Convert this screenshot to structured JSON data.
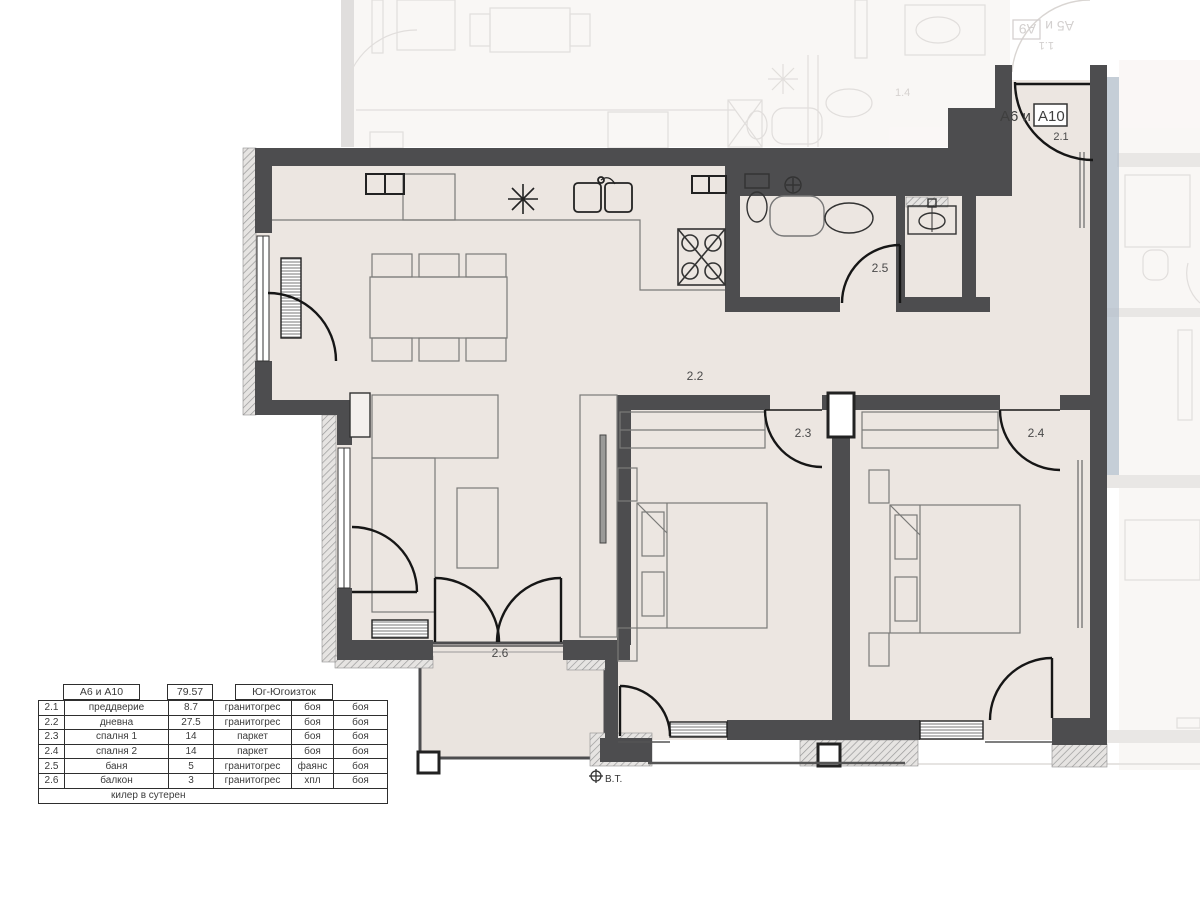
{
  "plan": {
    "apartment_label": {
      "prefix": "А6 и",
      "boxed": "А10"
    },
    "room_labels": {
      "r21": "2.1",
      "r22": "2.2",
      "r23": "2.3",
      "r24": "2.4",
      "r25": "2.5",
      "r26": "2.6"
    },
    "survey_marker": "В.Т.",
    "faded_labels": {
      "upper_apartment_prefix": "А5 и",
      "upper_apartment_boxed": "А9",
      "upper_room": "1.1",
      "upper_neighbor_room": "1.4"
    },
    "colors": {
      "wall": "#4d4d4f",
      "floor": "#ece6e1",
      "accent_band": "#b7c2cd",
      "hatch_line": "#9a9a9a",
      "faded_stroke": "#c9c4c0"
    }
  },
  "table": {
    "header": {
      "apartment": "А6 и А10",
      "total_area": "79.57",
      "exposure": "Юг-Югоизток"
    },
    "rows": [
      {
        "num": "2.1",
        "name": "преддверие",
        "area": "8.7",
        "floor": "гранитогрес",
        "walls": "боя",
        "ceiling": "боя"
      },
      {
        "num": "2.2",
        "name": "дневна",
        "area": "27.5",
        "floor": "гранитогрес",
        "walls": "боя",
        "ceiling": "боя"
      },
      {
        "num": "2.3",
        "name": "спалня 1",
        "area": "14",
        "floor": "паркет",
        "walls": "боя",
        "ceiling": "боя"
      },
      {
        "num": "2.4",
        "name": "спалня 2",
        "area": "14",
        "floor": "паркет",
        "walls": "боя",
        "ceiling": "боя"
      },
      {
        "num": "2.5",
        "name": "баня",
        "area": "5",
        "floor": "гранитогрес",
        "walls": "фаянс",
        "ceiling": "боя"
      },
      {
        "num": "2.6",
        "name": "балкон",
        "area": "3",
        "floor": "гранитогрес",
        "walls": "хпл",
        "ceiling": "боя"
      }
    ],
    "footer": "килер в сутерен"
  }
}
